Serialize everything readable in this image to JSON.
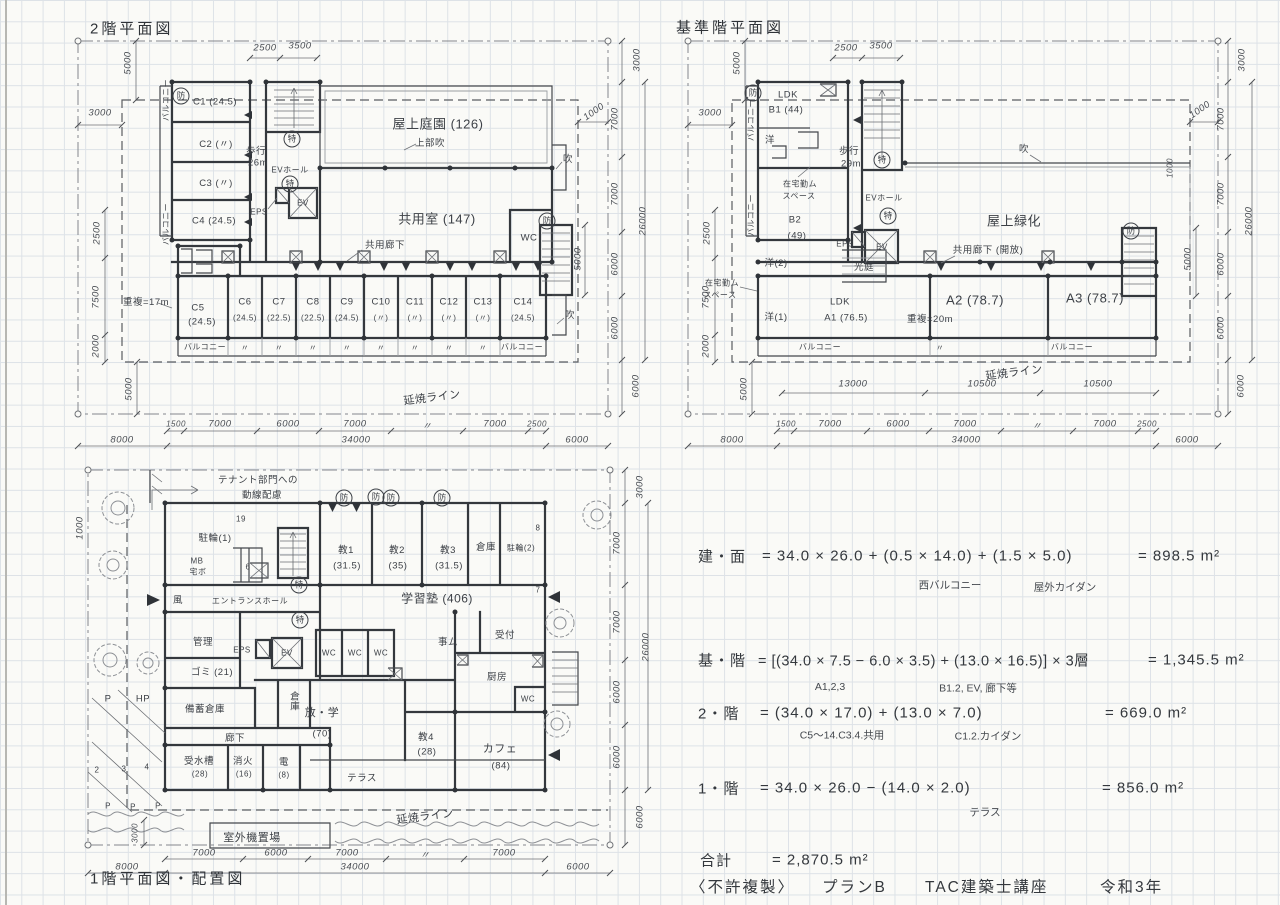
{
  "p1": {
    "title": "2階平面図",
    "rooms": [
      "C1 (24.5)",
      "C2 (〃)",
      "C3 (〃)",
      "C4 (24.5)"
    ],
    "c5": "C5",
    "c5v": "(24.5)",
    "row": [
      [
        "C6",
        "(24.5)"
      ],
      [
        "C7",
        "(22.5)"
      ],
      [
        "C8",
        "(22.5)"
      ],
      [
        "C9",
        "(24.5)"
      ],
      [
        "C10",
        "(〃)"
      ],
      [
        "C11",
        "(〃)"
      ],
      [
        "C12",
        "(〃)"
      ],
      [
        "C13",
        "(〃)"
      ],
      [
        "C14",
        "(24.5)"
      ]
    ],
    "walk1": "歩行",
    "walk2": "26m",
    "evhall": "EVホール",
    "eps": "EPS",
    "ev": "EV",
    "roof_garden": "屋上庭園 (126)",
    "upper_void": "上部吹",
    "common_room": "共用室 (147)",
    "corridor": "共用廊下",
    "wc": "WC",
    "void": "吹",
    "overlap": "重複=17m",
    "balcony": "バルコニー",
    "ditto": "〃",
    "fire_line": "延焼ライン",
    "bou": "防",
    "toku": "特",
    "dims": {
      "top": [
        "2500",
        "3500"
      ],
      "left": [
        "3000",
        "5000",
        "2500",
        "7500",
        "2000",
        "5000"
      ],
      "right": [
        "3000",
        "1000",
        "7000",
        "7000",
        "6000",
        "6000",
        "5000",
        "26000",
        "6000"
      ],
      "bottom": [
        "1500",
        "7000",
        "6000",
        "7000",
        "〃",
        "7000",
        "2500",
        "8000",
        "34000",
        "6000"
      ]
    }
  },
  "p2": {
    "title": "基準階平面図",
    "ldk": "LDK",
    "b1": "B1 (44)",
    "yo": "洋",
    "tw1": "在宅勤ム",
    "tw2": "スペース",
    "b2": "B2",
    "b2v": "(49)",
    "walk1": "歩行",
    "walk2": "29m",
    "evhall": "EVホール",
    "eps": "EPS",
    "ev": "EV",
    "roof_green": "屋上緑化",
    "corridor": "共用廊下 (開放)",
    "void": "吹",
    "yo2": "洋(2)",
    "yo1": "洋(1)",
    "court": "光庭",
    "ldk2": "LDK",
    "a1": "A1 (76.5)",
    "overlap": "重複=20m",
    "a2": "A2 (78.7)",
    "a3": "A3 (78.7)",
    "balcony": "バルコニー",
    "ditto": "〃",
    "fire_line": "延焼ライン",
    "bou": "防",
    "toku": "特",
    "dims": {
      "top": [
        "2500",
        "3500"
      ],
      "left": [
        "3000",
        "5000",
        "2500",
        "7500",
        "2000",
        "5000"
      ],
      "right": [
        "1000",
        "3000",
        "7000",
        "7000",
        "6000",
        "6000",
        "1000",
        "5000",
        "26000",
        "6000"
      ],
      "mid": [
        "13000",
        "10500",
        "10500"
      ],
      "bottom": [
        "1500",
        "7000",
        "6000",
        "7000",
        "〃",
        "7000",
        "2500",
        "8000",
        "34000",
        "6000"
      ]
    }
  },
  "p3": {
    "title": "1階平面図・配置図",
    "note1": "テナント部門への",
    "note2": "動線配慮",
    "bike1": "駐輪(1)",
    "n19": "19",
    "n6": "6",
    "mb": "MB",
    "takubo": "宅ボ",
    "wind": "風",
    "entrance": "エントランスホール",
    "k1": "教1",
    "k1v": "(31.5)",
    "k2": "教2",
    "k2v": "(35)",
    "k3": "教3",
    "k3v": "(31.5)",
    "soko1": "倉庫",
    "bike2": "駐輪(2)",
    "n8": "8",
    "n7": "7",
    "juku": "学習塾 (406)",
    "kanri": "管理",
    "eps": "EPS",
    "ev": "EV",
    "wc": "WC",
    "jimu": "事ム",
    "uketsuke": "受付",
    "gomi": "ゴミ (21)",
    "soko2": "倉庫",
    "chubo": "厨房",
    "bichiku": "備蓄倉庫",
    "roka": "廊下",
    "jusui": "受水槽",
    "jusuiv": "(28)",
    "shoka": "消火",
    "shokav": "(16)",
    "den": "電",
    "denv": "(8)",
    "hogaku": "放・学",
    "hogakuv": "(70)",
    "k4": "教4",
    "k4v": "(28)",
    "cafe": "カフェ",
    "cafev": "(84)",
    "terrace": "テラス",
    "p": "P",
    "hp": "HP",
    "n2": "2",
    "n3": "3",
    "n4": "4",
    "outdoor": "室外機置場",
    "fire_line": "延焼ライン",
    "bou": "防",
    "toku": "特",
    "dims": {
      "left": [
        "1000"
      ],
      "right": [
        "3000",
        "7000",
        "7000",
        "6000",
        "6000",
        "26000",
        "6000"
      ],
      "bottom": [
        "7000",
        "6000",
        "7000",
        "〃",
        "7000",
        "8000",
        "34000",
        "6000"
      ],
      "small": "3000"
    }
  },
  "calc": {
    "l1": {
      "label": "建・面",
      "formula": "= 34.0 × 26.0 + (0.5 × 14.0) + (1.5 × 5.0)",
      "result": "= 898.5 m²",
      "n1": "西バルコニー",
      "n2": "屋外カイダン"
    },
    "l2": {
      "label": "基・階",
      "formula": "= [(34.0 × 7.5 − 6.0 × 3.5) + (13.0 × 16.5)] × 3層",
      "result": "= 1,345.5 m²",
      "n1": "A1,2,3",
      "n2": "B1.2, EV, 廊下等"
    },
    "l3": {
      "label": "2・階",
      "formula": "= (34.0 × 17.0) + (13.0 × 7.0)",
      "result": "= 669.0 m²",
      "n1": "C5〜14.C3.4.共用",
      "n2": "C1.2.カイダン"
    },
    "l4": {
      "label": "1・階",
      "formula": "= 34.0 × 26.0 − (14.0 × 2.0)",
      "result": "= 856.0 m²",
      "n1": "テラス"
    },
    "total": {
      "label": "合計",
      "value": "= 2,870.5 m²"
    }
  },
  "footer": {
    "stamp": "〈不許複製〉",
    "plan": "プランB",
    "course": "TAC建築士講座",
    "year": "令和3年"
  }
}
